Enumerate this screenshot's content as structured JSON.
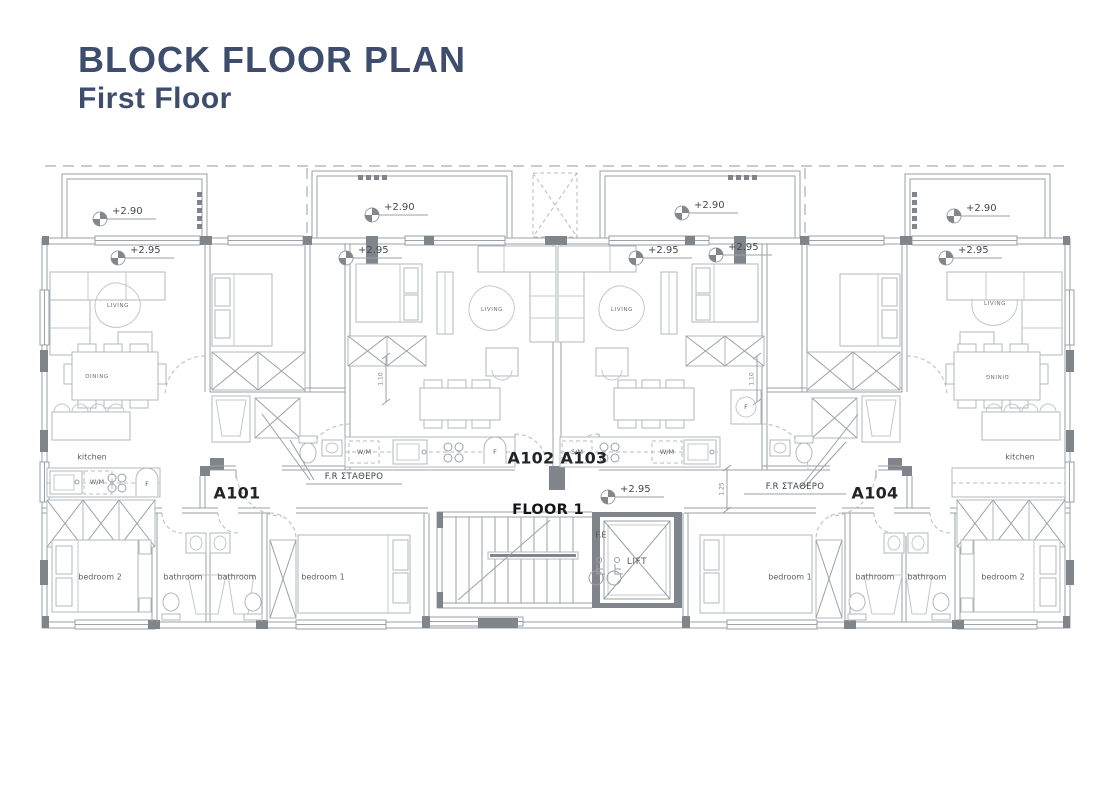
{
  "title": {
    "heading": "BLOCK FLOOR PLAN",
    "subheading": "First Floor"
  },
  "levels": {
    "balcony_level": "+2.90",
    "floor_level": "+2.95"
  },
  "core": {
    "floor_label": "FLOOR 1",
    "lift_label": "LIFT",
    "fire_escape_label": "F.E"
  },
  "apartments": {
    "a101": "A101",
    "a102": "A102",
    "a103": "A103",
    "a104": "A104"
  },
  "rooms": {
    "living": "LIVING",
    "dining": "DINING",
    "kitchen": "kitchen",
    "bedroom_1": "bedroom 1",
    "bedroom_2": "bedroom 2",
    "bathroom": "bathroom"
  },
  "appliances": {
    "washing_machine": "W/M",
    "dishwasher": "S/M",
    "fridge": "F"
  },
  "annotations": {
    "fixed_frame": "F.R ΣΤΑΘΕΡΟ",
    "dim_1_10": "1.10",
    "dim_1_25": "1.25"
  },
  "colors": {
    "title": "#3e4d6d",
    "wall_fill": "#7f858b",
    "line": "#9ba1a7",
    "label": "#54585d"
  }
}
